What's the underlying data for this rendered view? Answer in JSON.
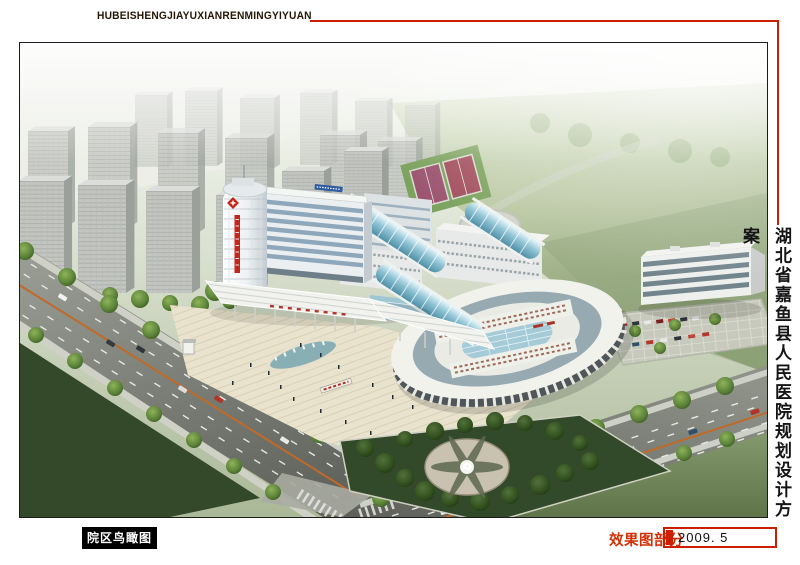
{
  "header": {
    "latin_title": "HUBEISHENGJIAYUXIANRENMINGYIYUAN"
  },
  "side_title": {
    "text": "湖北省嘉鱼县人民医院规划设计方案"
  },
  "image": {
    "caption": "院区鸟瞰图"
  },
  "footer": {
    "section_label": "效果图部分",
    "date": "2009. 5"
  },
  "palette": {
    "line-red": "#cc1e00",
    "accent": "#c5261b",
    "footer-red": "#d03005",
    "badge-bg": "#000000",
    "badge-fg": "#ffffff",
    "frame-border": "#1b1b1b",
    "date-color": "#111111",
    "lawn-green": "#8da379",
    "road-gray": "#63665f",
    "tree-green": "#5b8338",
    "vault-teal": "#8fc3d4",
    "plaza-beige": "#e9e2cd",
    "building-white": "#eceff1"
  }
}
